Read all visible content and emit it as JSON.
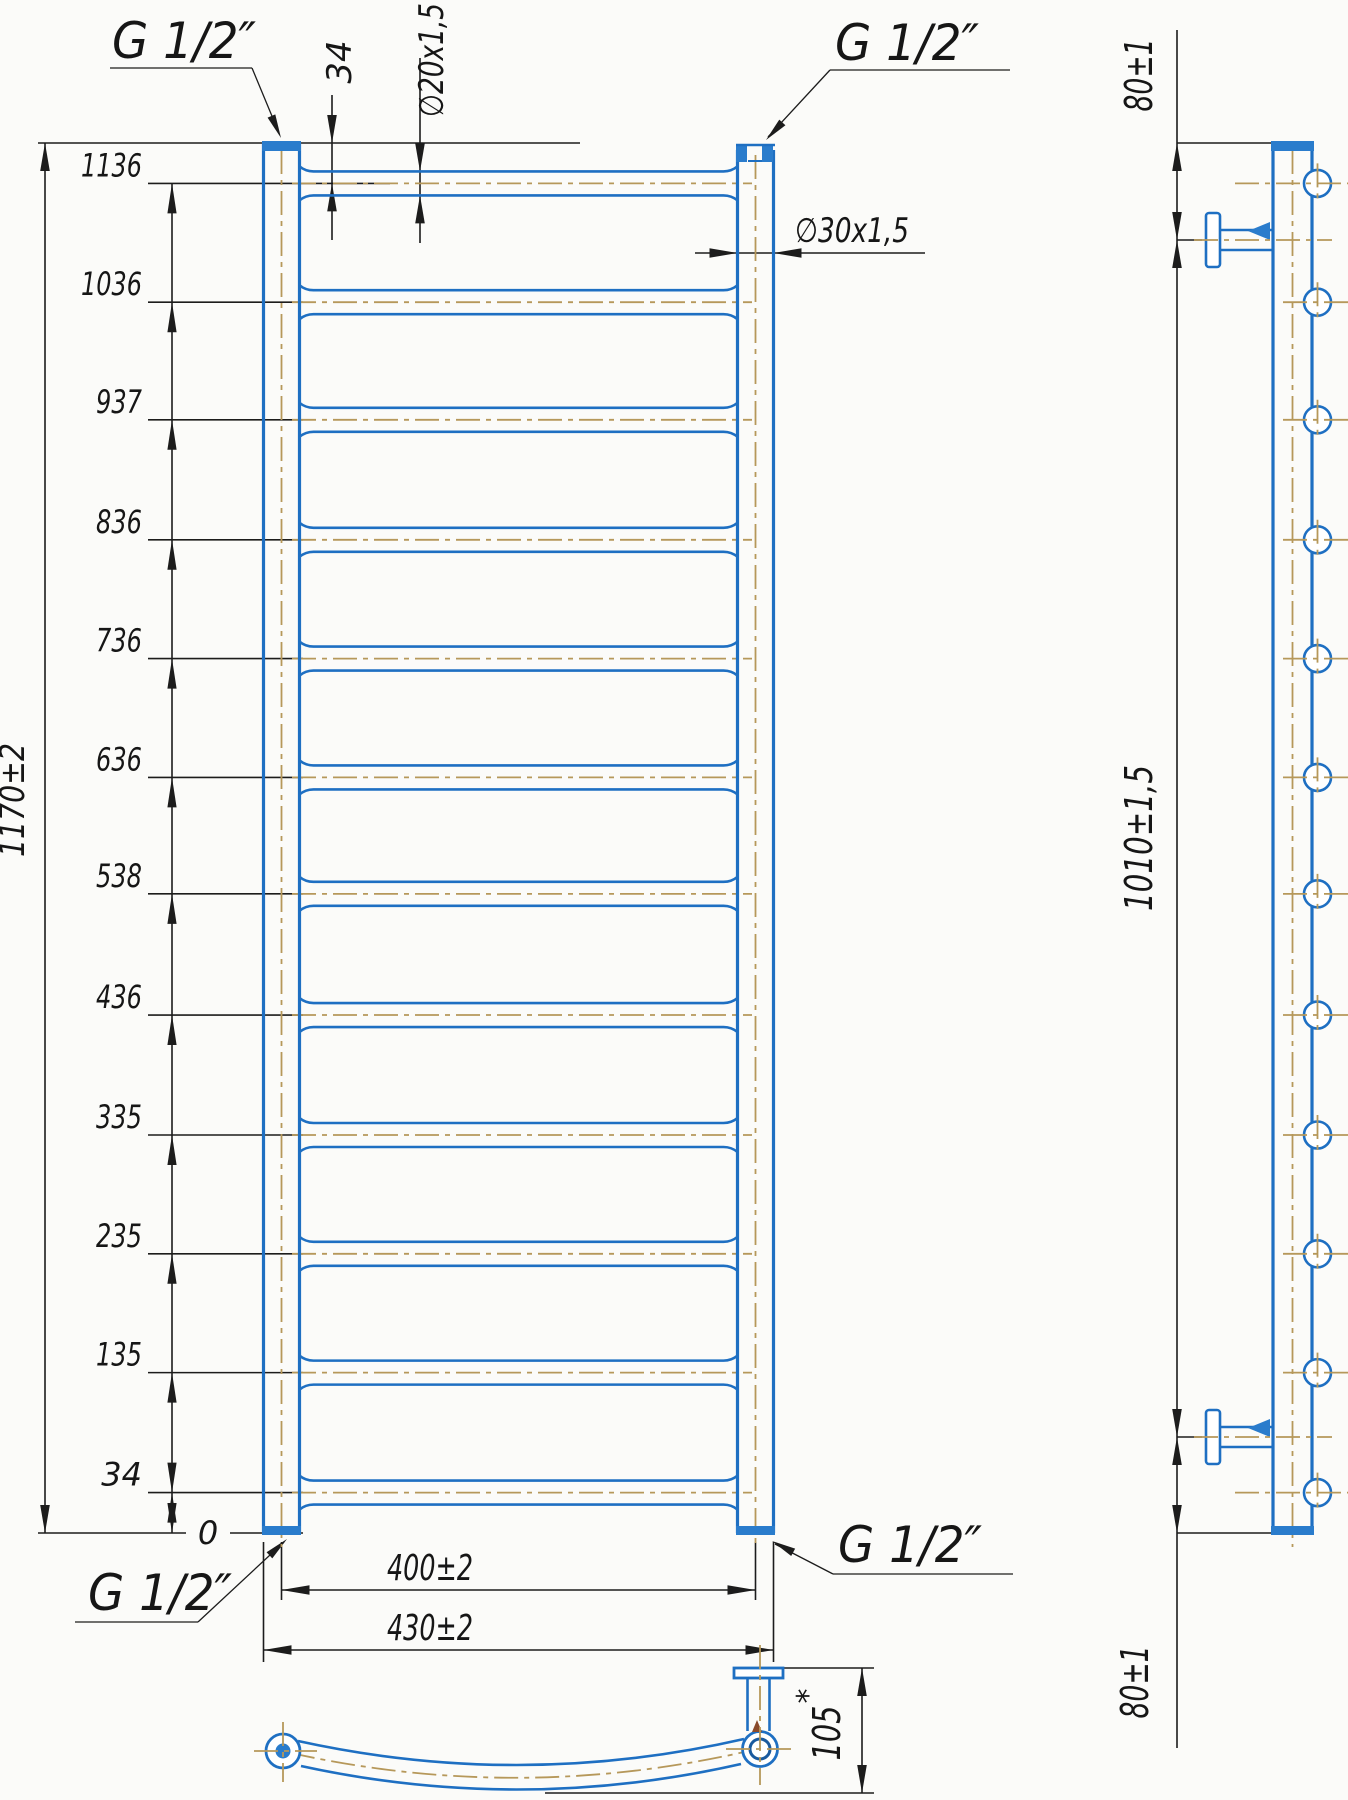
{
  "front_view": {
    "thread_labels": {
      "top_left": "G 1/2″",
      "top_right": "G 1/2″",
      "bottom_left": "G 1/2″",
      "bottom_right": "G 1/2″"
    },
    "height_dimensions": [
      "34",
      "135",
      "235",
      "335",
      "436",
      "538",
      "636",
      "736",
      "836",
      "937",
      "1036",
      "1136"
    ],
    "rung_offsets_mm": [
      34,
      135,
      235,
      335,
      436,
      538,
      636,
      736,
      836,
      937,
      1036,
      1136
    ],
    "rung_count": 12,
    "zero_label": "0",
    "overall_height": "1170±2",
    "top_offset": "34",
    "rung_tube_dia": "∅20x1,5",
    "riser_tube_dia": "∅30x1,5",
    "axis_width": "400±2",
    "overall_width": "430±2"
  },
  "side_view": {
    "top_bracket_offset": "80±1",
    "bracket_span": "1010±1,5",
    "bottom_bracket_offset": "80±1"
  },
  "bottom_view": {
    "bow_depth": "105",
    "note_mark": "*"
  },
  "colors": {
    "pipe_blue": "#1e6fc2",
    "pipe_fill": "#2a7ccc",
    "pipe_dark": "#1a5a9e",
    "centerline_olive": "#b6985a",
    "dimension_black": "#1c1c1c",
    "background": "#fbfbf9"
  }
}
